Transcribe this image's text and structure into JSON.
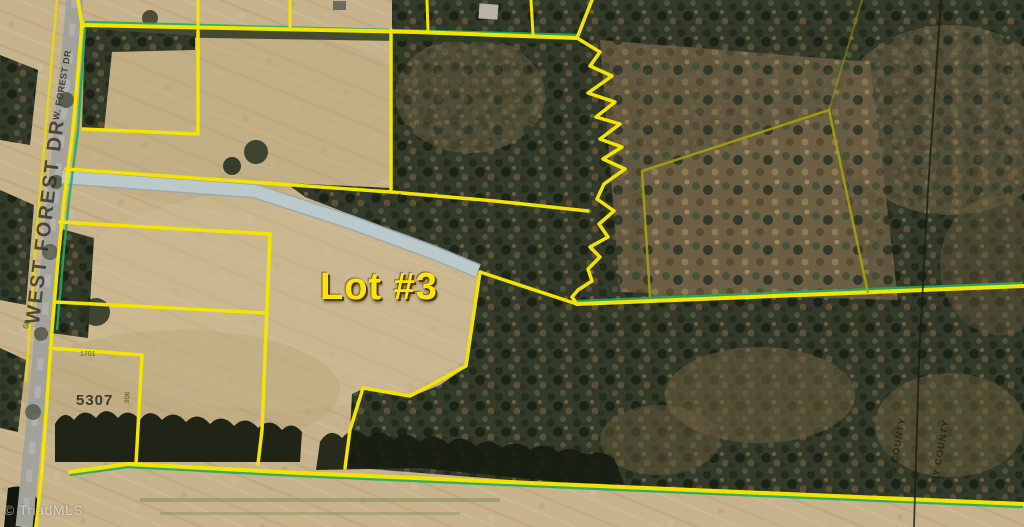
{
  "map": {
    "lot_label": "Lot #3",
    "road": {
      "name_full": "WEST FOREST DR",
      "name_abbr": "W. FOREST DR",
      "width_marker": "60"
    },
    "parcels": {
      "house_number": "5307",
      "id_small_1": "1610",
      "id_small_2": "1701",
      "id_small_3": "906"
    },
    "counties": {
      "west_fragment": "S COUNTY",
      "east_fragment": "RY COUNTY"
    },
    "watermark": "© TriadMLS",
    "colors": {
      "boundary_yellow": "#f3e400",
      "outer_green_accent": "#23aa5e",
      "secondary_olive_boundary": "#a8a30a",
      "driveway_gray": "#b9c6c8",
      "lot_label_yellow": "#ffe30a",
      "county_line_black": "#1a1a12",
      "field_tan": "#c6b28b",
      "forest_dark": "#333a29"
    }
  }
}
